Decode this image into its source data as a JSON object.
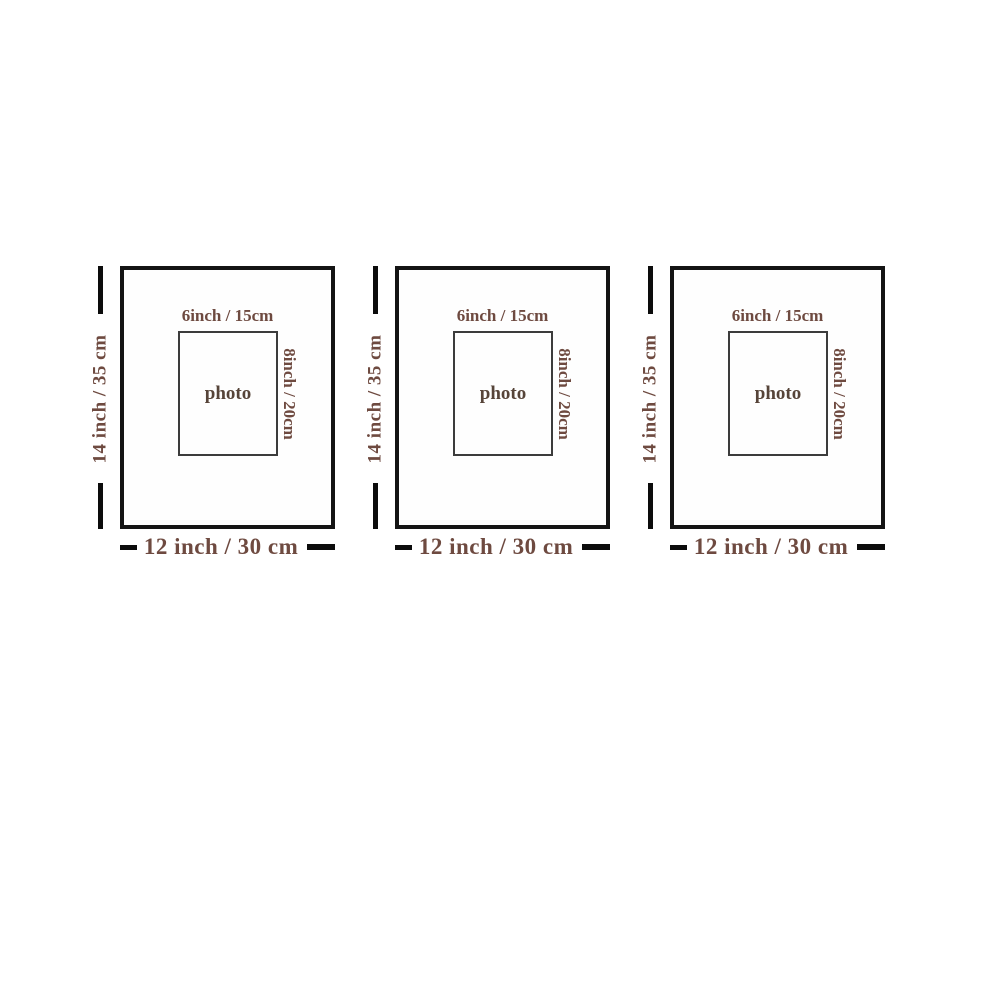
{
  "colors": {
    "background": "#ffffff",
    "dimension_bar": "#0c0c0c",
    "mat_border": "#141414",
    "window_border": "#3c3c3c",
    "dimension_text": "#6e4a40",
    "photo_text": "#564439"
  },
  "units": [
    {
      "mat_height_label": "14 inch / 35 cm",
      "mat_width_label": "12 inch / 30 cm",
      "opening_width_label": "6inch / 15cm",
      "opening_height_label": "8inch / 20cm",
      "photo_label": "photo"
    },
    {
      "mat_height_label": "14 inch / 35 cm",
      "mat_width_label": "12 inch / 30 cm",
      "opening_width_label": "6inch / 15cm",
      "opening_height_label": "8inch / 20cm",
      "photo_label": "photo"
    },
    {
      "mat_height_label": "14 inch / 35 cm",
      "mat_width_label": "12 inch / 30 cm",
      "opening_width_label": "6inch / 15cm",
      "opening_height_label": "8inch / 20cm",
      "photo_label": "photo"
    }
  ]
}
